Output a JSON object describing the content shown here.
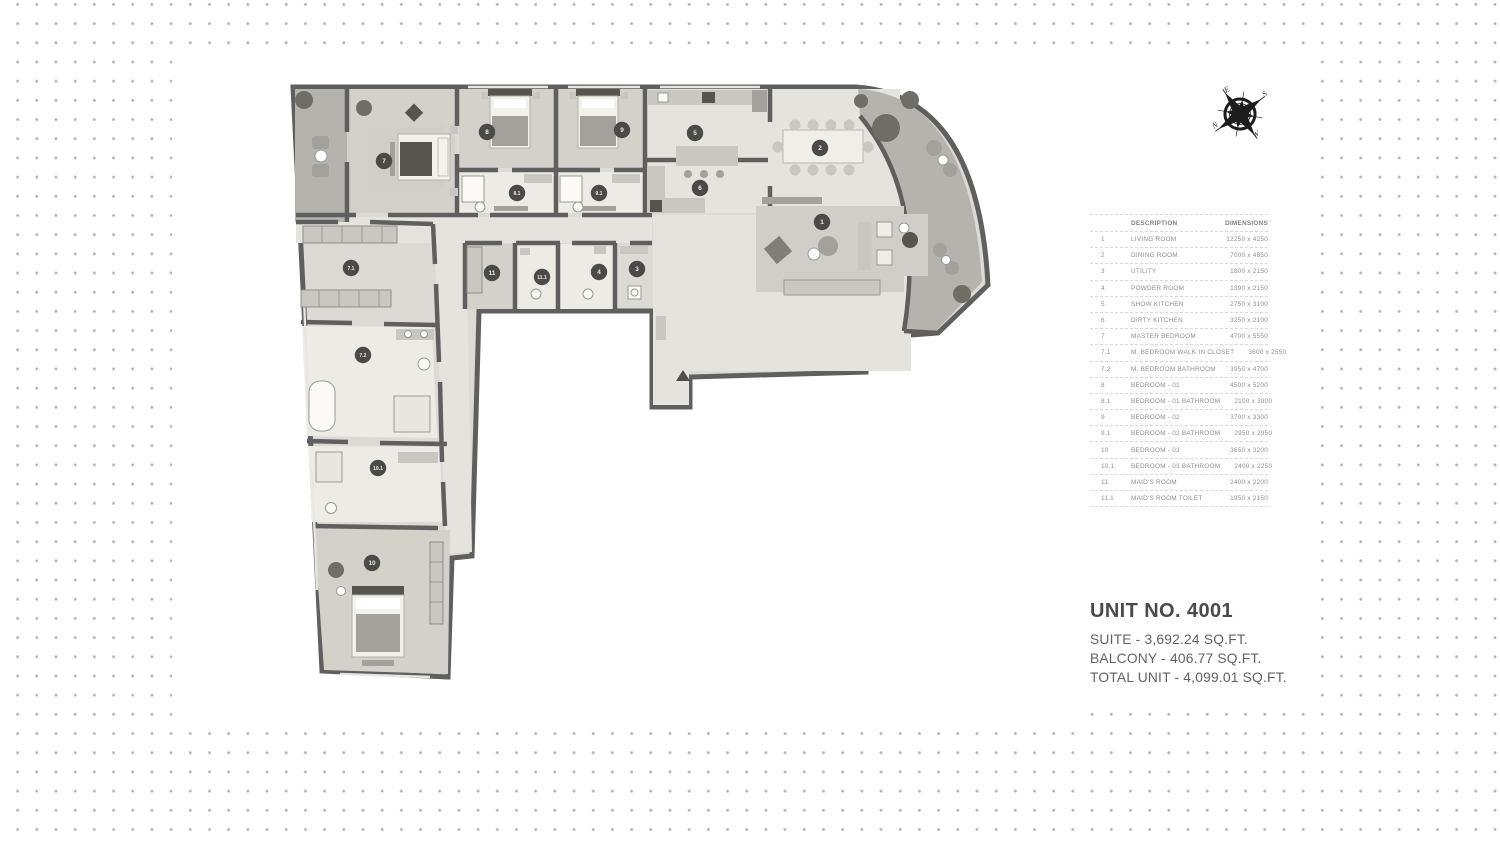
{
  "table": {
    "headers": {
      "description": "DESCRIPTION",
      "dimensions": "DIMENSIONS"
    },
    "rows": [
      {
        "no": "1",
        "description": "LIVING ROOM",
        "dimensions": "12250 x 4250"
      },
      {
        "no": "2",
        "description": "DINING ROOM",
        "dimensions": "7000 x 4850"
      },
      {
        "no": "3",
        "description": "UTILITY",
        "dimensions": "1800 x 2150"
      },
      {
        "no": "4",
        "description": "POWDER ROOM",
        "dimensions": "1390 x 2150"
      },
      {
        "no": "5",
        "description": "SHOW KITCHEN",
        "dimensions": "2750 x 3100"
      },
      {
        "no": "6",
        "description": "DIRTY KITCHEN",
        "dimensions": "3250 x 2100"
      },
      {
        "no": "7",
        "description": "MASTER BEDROOM",
        "dimensions": "4700 x 5550"
      },
      {
        "no": "7.1",
        "description": "M. BEDROOM WALK IN CLOSET",
        "dimensions": "3600 x 2550"
      },
      {
        "no": "7.2",
        "description": "M. BEDROOM BATHROOM",
        "dimensions": "3950 x 4700"
      },
      {
        "no": "8",
        "description": "BEDROOM - 01",
        "dimensions": "4500 x 5200"
      },
      {
        "no": "8.1",
        "description": "BEDROOM - 01 BATHROOM",
        "dimensions": "2100 x 3800"
      },
      {
        "no": "9",
        "description": "BEDROOM - 02",
        "dimensions": "3700 x 3300"
      },
      {
        "no": "9.1",
        "description": "BEDROOM - 02 BATHROOM",
        "dimensions": "2950 x 2950"
      },
      {
        "no": "10",
        "description": "BEDROOM - 03",
        "dimensions": "3650 x 3200"
      },
      {
        "no": "10.1",
        "description": "BEDROOM - 03 BATHROOM",
        "dimensions": "2400 x 2250"
      },
      {
        "no": "11",
        "description": "MAID'S ROOM",
        "dimensions": "2400 x 2200"
      },
      {
        "no": "11.1",
        "description": "MAID'S ROOM TOILET",
        "dimensions": "1950 x 2150"
      }
    ]
  },
  "unit_info": {
    "title": "UNIT NO. 4001",
    "suite": "SUITE - 3,692.24 SQ.FT.",
    "balcony": "BALCONY - 406.77 SQ.FT.",
    "total": "TOTAL UNIT - 4,099.01 SQ.FT."
  },
  "compass": {
    "n": "N",
    "e": "E",
    "s": "S",
    "w": "W"
  },
  "floor_plan": {
    "colors": {
      "wall": "#5f5f5f",
      "floor": "#dcdad5",
      "floor_wood": "#d3d1ca",
      "floor_light": "#e5e3dd",
      "bath": "#edebe5",
      "balcony": "#b4b3ae",
      "badge": "#4a4a48"
    },
    "badges": [
      {
        "no": "1",
        "x": 822,
        "y": 222
      },
      {
        "no": "2",
        "x": 820,
        "y": 148
      },
      {
        "no": "3",
        "x": 637,
        "y": 269
      },
      {
        "no": "4",
        "x": 599,
        "y": 272
      },
      {
        "no": "5",
        "x": 695,
        "y": 133
      },
      {
        "no": "6",
        "x": 700,
        "y": 188
      },
      {
        "no": "7",
        "x": 384,
        "y": 161
      },
      {
        "no": "7.1",
        "x": 351,
        "y": 268
      },
      {
        "no": "7.2",
        "x": 363,
        "y": 355
      },
      {
        "no": "8",
        "x": 487,
        "y": 132
      },
      {
        "no": "8.1",
        "x": 517,
        "y": 193
      },
      {
        "no": "9",
        "x": 622,
        "y": 130
      },
      {
        "no": "9.1",
        "x": 599,
        "y": 193
      },
      {
        "no": "10",
        "x": 372,
        "y": 563
      },
      {
        "no": "10.1",
        "x": 378,
        "y": 468
      },
      {
        "no": "11",
        "x": 492,
        "y": 273
      },
      {
        "no": "11.1",
        "x": 542,
        "y": 277
      }
    ]
  }
}
